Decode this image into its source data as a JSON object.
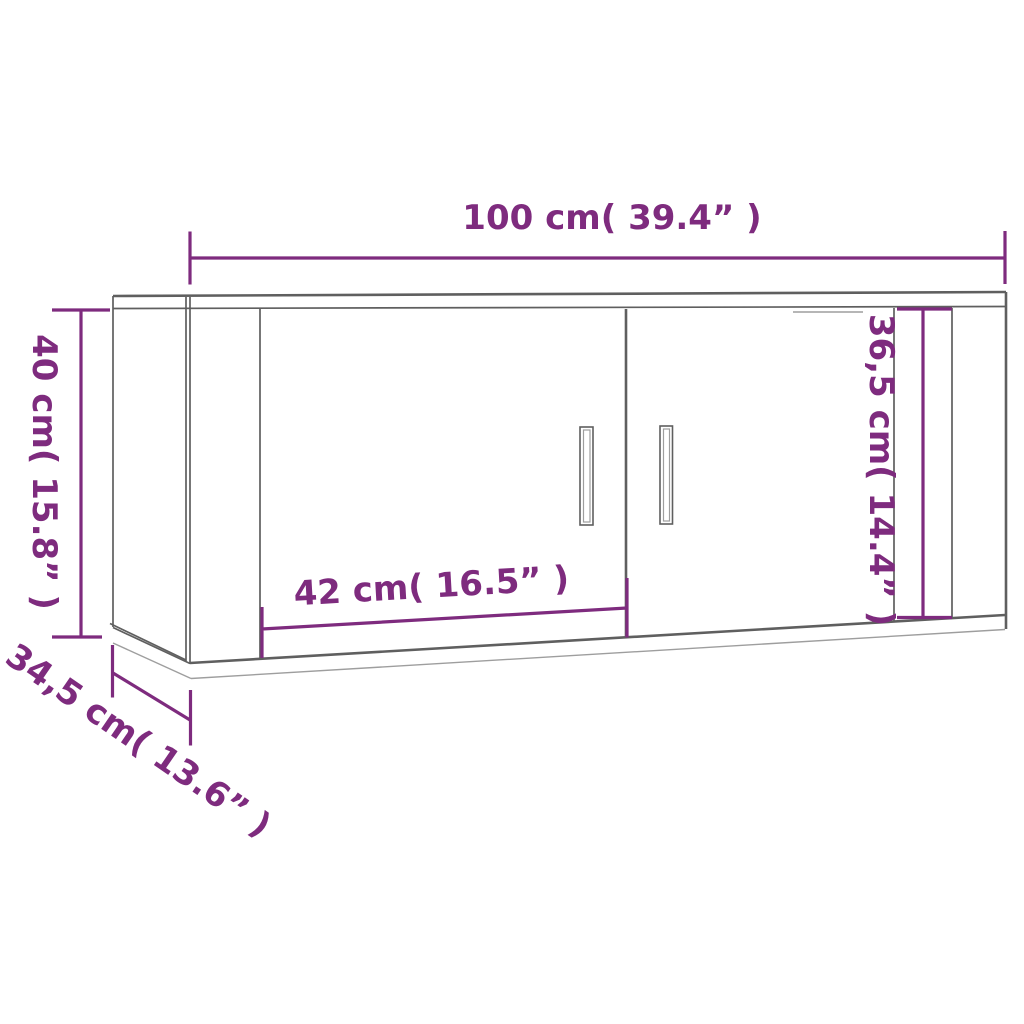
{
  "colors": {
    "dimension": "#7e2b7e",
    "outline_dark": "#5f5f5f",
    "outline_light": "#9e9e9e"
  },
  "dimensions": {
    "width": {
      "label": "100 cm( 39.4” )",
      "cm": "100",
      "inches": "39.4"
    },
    "height": {
      "label": "40 cm( 15.8” )",
      "cm": "40",
      "inches": "15.8"
    },
    "door_width": {
      "label": "42 cm( 16.5” )",
      "cm": "42",
      "inches": "16.5"
    },
    "inner_height": {
      "label": "36,5 cm( 14.4” )",
      "cm": "36,5",
      "inches": "14.4"
    },
    "depth": {
      "label": "34,5 cm( 13.6” )",
      "cm": "34,5",
      "inches": "13.6"
    }
  }
}
